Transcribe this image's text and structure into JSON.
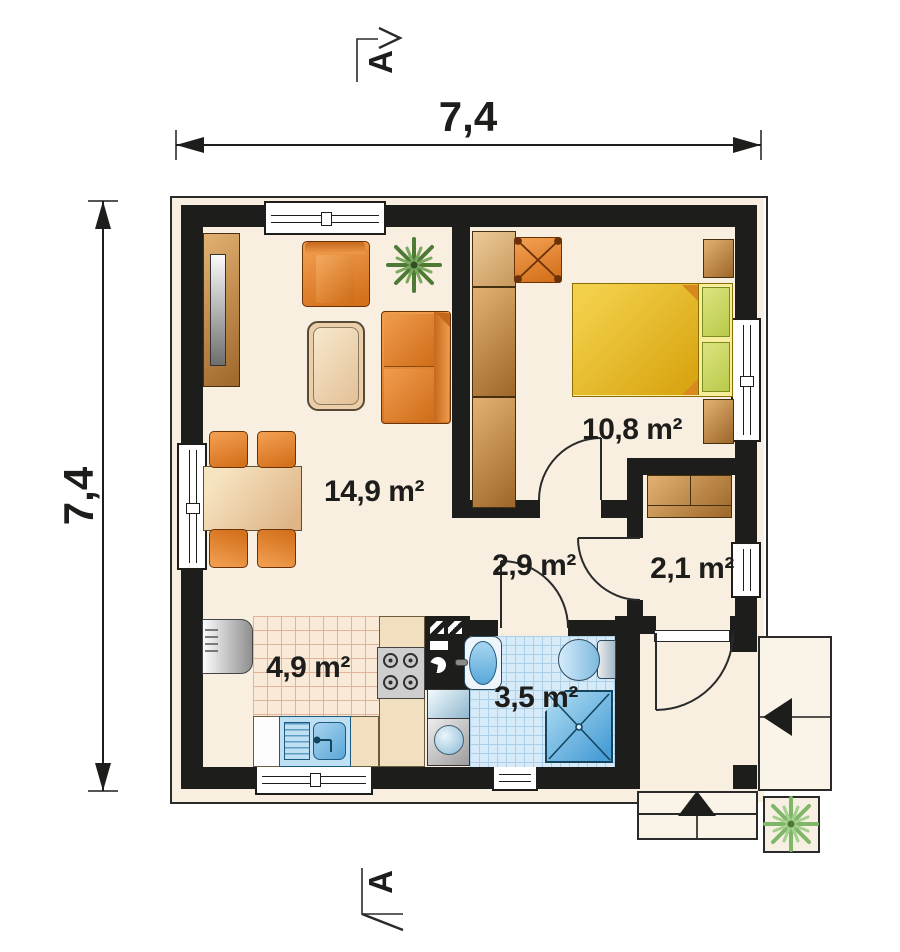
{
  "dimensions": {
    "width": "7,4",
    "height": "7,4"
  },
  "section_markers": {
    "top": "A",
    "bottom": "A"
  },
  "rooms": {
    "living": {
      "area": "14,9 m²"
    },
    "bedroom": {
      "area": "10,8 m²"
    },
    "hall": {
      "area": "2,9 m²"
    },
    "wardrobe": {
      "area": "2,1 m²"
    },
    "kitchen": {
      "area": "4,9 m²"
    },
    "bathroom": {
      "area": "3,5 m²"
    }
  },
  "colors": {
    "wall": "#1d1d1b",
    "floor": "#f8efe1",
    "furniture_orange": "#e07b28",
    "wood": "#b97e3e",
    "bed_yellow": "#eec63a",
    "bath_blue": "#d6eaf7",
    "plant_green": "#4e7a36"
  }
}
